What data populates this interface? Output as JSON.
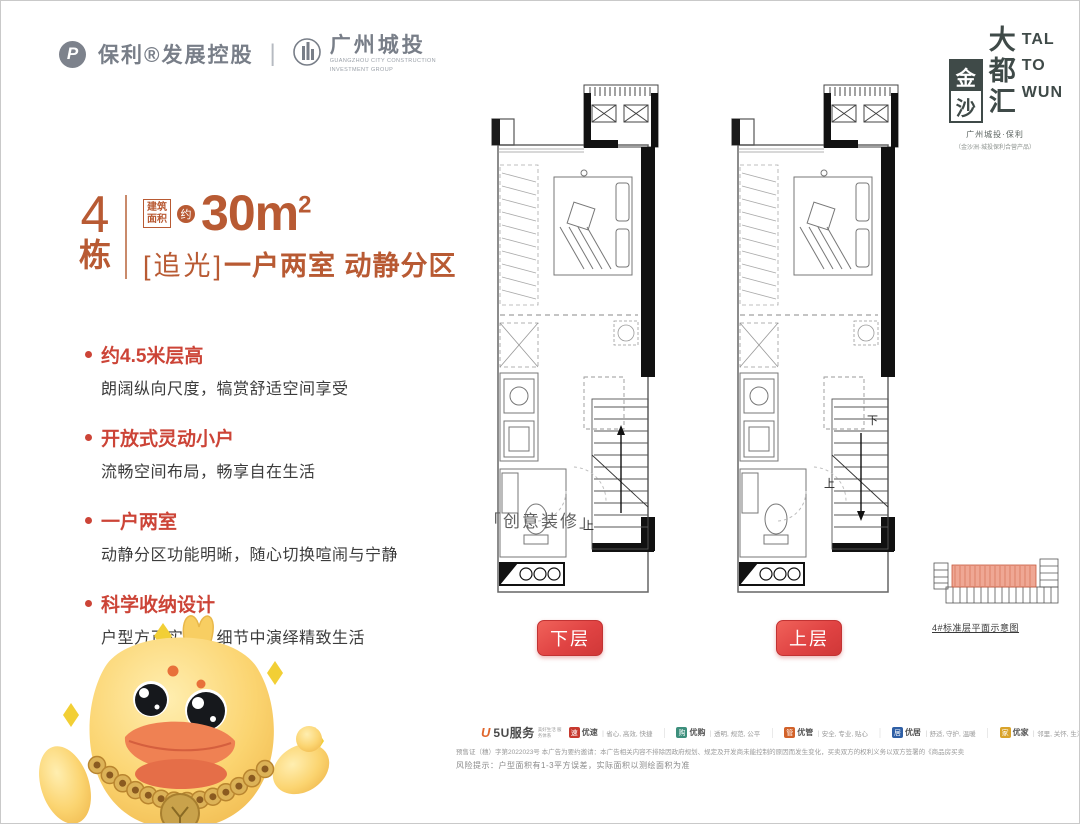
{
  "header": {
    "poly_mark": "P",
    "poly_name": "保利®发展控股",
    "divider": "|",
    "gz_name": "广州城投",
    "gz_en1": "GUANGZHOU CITY CONSTRUCTION",
    "gz_en2": "INVESTMENT GROUP"
  },
  "brand": {
    "seal_char1": "金",
    "seal_char2": "沙",
    "big_chars": [
      "大",
      "都",
      "汇"
    ],
    "en_lines": [
      "TAL",
      "TO",
      "WUN"
    ],
    "sub1": "广州城投·保利",
    "sub2": "（金沙洲·城投保利合营产品）"
  },
  "headline": {
    "building_no": "4",
    "building_unit": "栋",
    "area_box_line1": "建筑",
    "area_box_line2": "面积",
    "approx": "约",
    "area_value": "30",
    "area_unit": "m",
    "area_sup": "2",
    "tagline_bracket": "[追光]",
    "tagline_text": "一户两室 动静分区"
  },
  "features": [
    {
      "title": "约4.5米层高",
      "desc": "朗阔纵向尺度，犒赏舒适空间享受"
    },
    {
      "title": "开放式灵动小户",
      "desc": "流畅空间布局，畅享自在生活"
    },
    {
      "title": "一户两室",
      "desc": "动静分区功能明晰，随心切换喧闹与宁静"
    },
    {
      "title": "科学收纳设计",
      "desc": "户型方正实用，细节中演绎精致生活"
    }
  ],
  "plans": [
    {
      "button_label": "下层",
      "stair_labels": [
        {
          "text": "上",
          "x": 95,
          "y": 452
        }
      ],
      "arrow_dir": "up"
    },
    {
      "button_label": "上层",
      "stair_labels": [
        {
          "text": "下",
          "x": 139,
          "y": 347
        },
        {
          "text": "上",
          "x": 96,
          "y": 410
        }
      ],
      "arrow_dir": "down"
    }
  ],
  "deco_label": "「创意装修」",
  "schematic": {
    "caption": "4#标准层平面示意图",
    "highlight_color": "#e98a70"
  },
  "services": {
    "brand": "5U服务",
    "brand_sub": "美好生活 服务体系",
    "items": [
      {
        "name": "优速",
        "desc": "省心, 高效, 快捷",
        "color": "#c7392f"
      },
      {
        "name": "优购",
        "desc": "透明, 规范, 公平",
        "color": "#3d8f7c"
      },
      {
        "name": "优管",
        "desc": "安全, 专业, 贴心",
        "color": "#d2622a"
      },
      {
        "name": "优居",
        "desc": "舒适, 守护, 温暖",
        "color": "#2f5fa5"
      },
      {
        "name": "优家",
        "desc": "邻里, 关怀, 生活",
        "color": "#d9a32a"
      }
    ]
  },
  "disclaimer": {
    "line1": "预售证（穗）字第2022023号 本广告为要约邀请：本广告相关内容不排除因政府规划、规定及开发商未能控制的原因而发生变化，买卖双方的权利义务以双方签署的《商品房买卖合同》及附件等书面协议为准，敬请留意最新资料。",
    "line2": "风险提示：户型面积有1-3平方误差，实际面积以测绘面积为准"
  },
  "mascot": "duck-mascot",
  "colors": {
    "terracotta": "#b85a33",
    "feature_red": "#cc4437",
    "button_red": "#e04343",
    "brand_slate": "#3f4a48",
    "logo_gray": "#7d828c"
  }
}
